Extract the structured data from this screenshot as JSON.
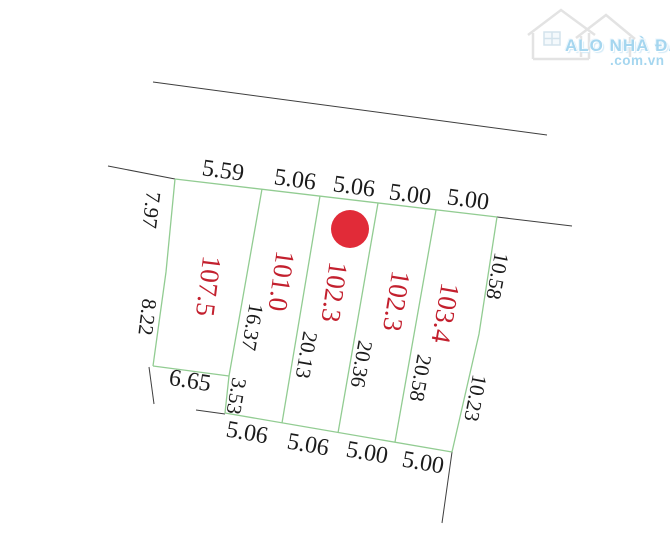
{
  "watermark": {
    "brand": "ALO NHÀ ĐẤT",
    "domain": ".com.vn"
  },
  "parcels": [
    {
      "area": "107.5"
    },
    {
      "area": "101.0"
    },
    {
      "area": "102.3"
    },
    {
      "area": "102.3"
    },
    {
      "area": "103.4"
    }
  ],
  "dimensions": {
    "top_edge": [
      "5.59",
      "5.06",
      "5.06",
      "5.00",
      "5.00"
    ],
    "bottom_edge": [
      "6.65",
      "5.06",
      "5.06",
      "5.00",
      "5.00"
    ],
    "left_edge": [
      "7.97",
      "8.22"
    ],
    "right_edge": [
      "10.58",
      "10.23"
    ],
    "dividers": [
      "16.37",
      "3.53",
      "20.13",
      "20.36",
      "20.58"
    ]
  },
  "marker": {
    "shape": "circle",
    "color": "#e12b38"
  },
  "palette": {
    "parcel_line": "#92cc92",
    "outer_line": "#3e3e3e",
    "area_label": "#c3202e",
    "dimension_label": "#1b1b1b",
    "watermark_blue": "#a5d6ef"
  }
}
